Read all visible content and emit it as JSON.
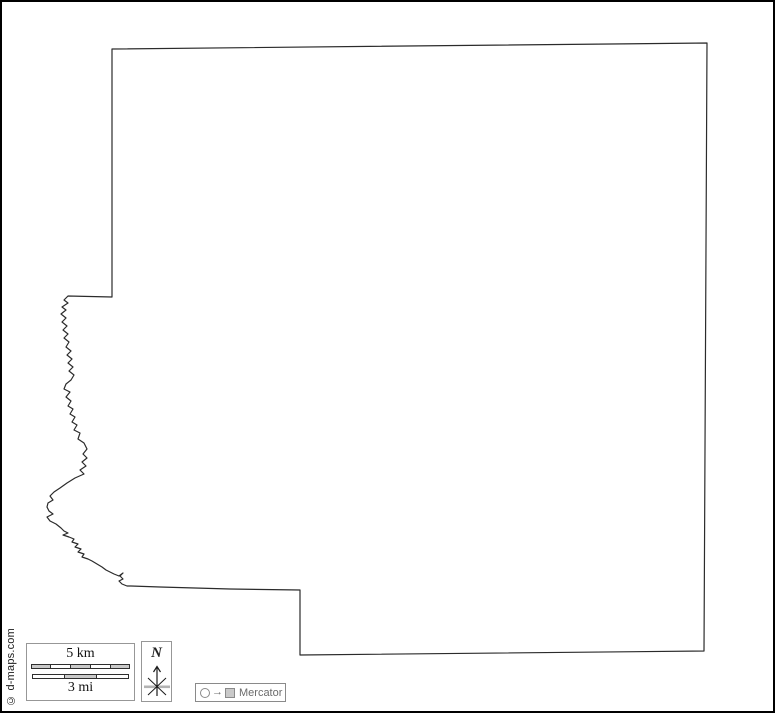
{
  "map": {
    "region_outline_path": "M112,49 L112,297 L68,296 L64,300 L68,303 L62,307 L66,310 L61,314 L66,318 L62,322 L67,326 L63,330 L68,334 L64,338 L69,342 L66,347 L71,351 L67,355 L72,359 L68,363 L73,367 L69,371 L74,375 L71,380 L66,384 L64,389 L70,392 L66,397 L71,401 L68,406 L73,409 L70,414 L75,417 L72,422 L77,425 L74,430 L80,433 L78,439 L84,443 L87,449 L83,454 L87,458 L82,462 L86,466 L80,470 L84,474 L75,478 L67,483 L60,488 L54,492 L50,496 L53,500 L48,503 L47,507 L49,511 L53,514 L47,517 L50,521 L56,524 L61,528 L64,531 L68,533 L63,535 L69,537 L74,539 L72,542 L78,544 L75,547 L81,549 L78,552 L84,554 L82,557 L88,559 L92,561 L97,564 L102,567 L106,570 L110,572 L114,574 L119,576 L123,573 L120,576 L123,579 L119,581 L122,584 L127,586 L131,586 L160,587 L230,589 L300,590 L300,655 L704,651 L707,43 Z",
    "outline_color": "#2b2b2b",
    "fill_color": "#ffffff"
  },
  "scale_bar": {
    "km_label": "5 km",
    "mi_label": "3 mi"
  },
  "compass": {
    "north_label": "N"
  },
  "projection": {
    "label": "Mercator"
  },
  "copyright": "© d-maps.com",
  "colors": {
    "frame": "#000000",
    "box_border": "#979797",
    "bar_gray": "#c9c9c9",
    "projection_text": "#6b6b6b"
  }
}
